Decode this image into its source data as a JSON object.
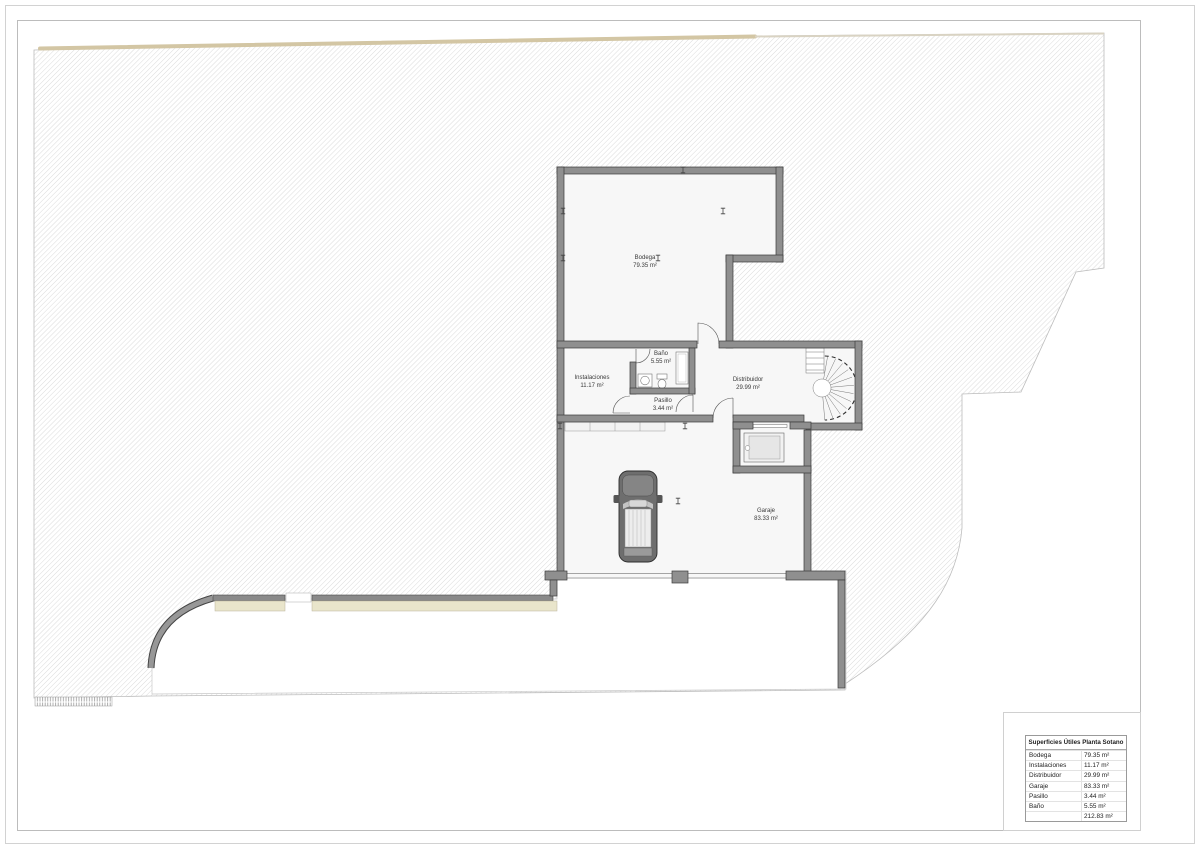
{
  "rooms": {
    "bodega": {
      "name": "Bodega",
      "area": "79.35 m²"
    },
    "instalaciones": {
      "name": "Instalaciones",
      "area": "11.17 m²"
    },
    "bano": {
      "name": "Baño",
      "area": "5.55 m²"
    },
    "pasillo": {
      "name": "Pasillo",
      "area": "3.44 m²"
    },
    "distribuidor": {
      "name": "Distribuidor",
      "area": "29.99 m²"
    },
    "garaje": {
      "name": "Garaje",
      "area": "83.33 m²"
    }
  },
  "legend": {
    "title": "Superficies Útiles Planta Sotano",
    "rows": [
      {
        "label": "Bodega",
        "value": "79.35 m²"
      },
      {
        "label": "Instalaciones",
        "value": "11.17 m²"
      },
      {
        "label": "Distribuidor",
        "value": "29.99 m²"
      },
      {
        "label": "Garaje",
        "value": "83.33 m²"
      },
      {
        "label": "Pasillo",
        "value": "3.44 m²"
      },
      {
        "label": "Baño",
        "value": "5.55 m²"
      },
      {
        "label": "",
        "value": "212.83 m²"
      }
    ]
  },
  "colors": {
    "boundary_line": "#d3c6a4",
    "terrain_hatch": "#d7d7d7",
    "wall_fill": "#8f8f8f",
    "planter": "#e9e5cb"
  }
}
